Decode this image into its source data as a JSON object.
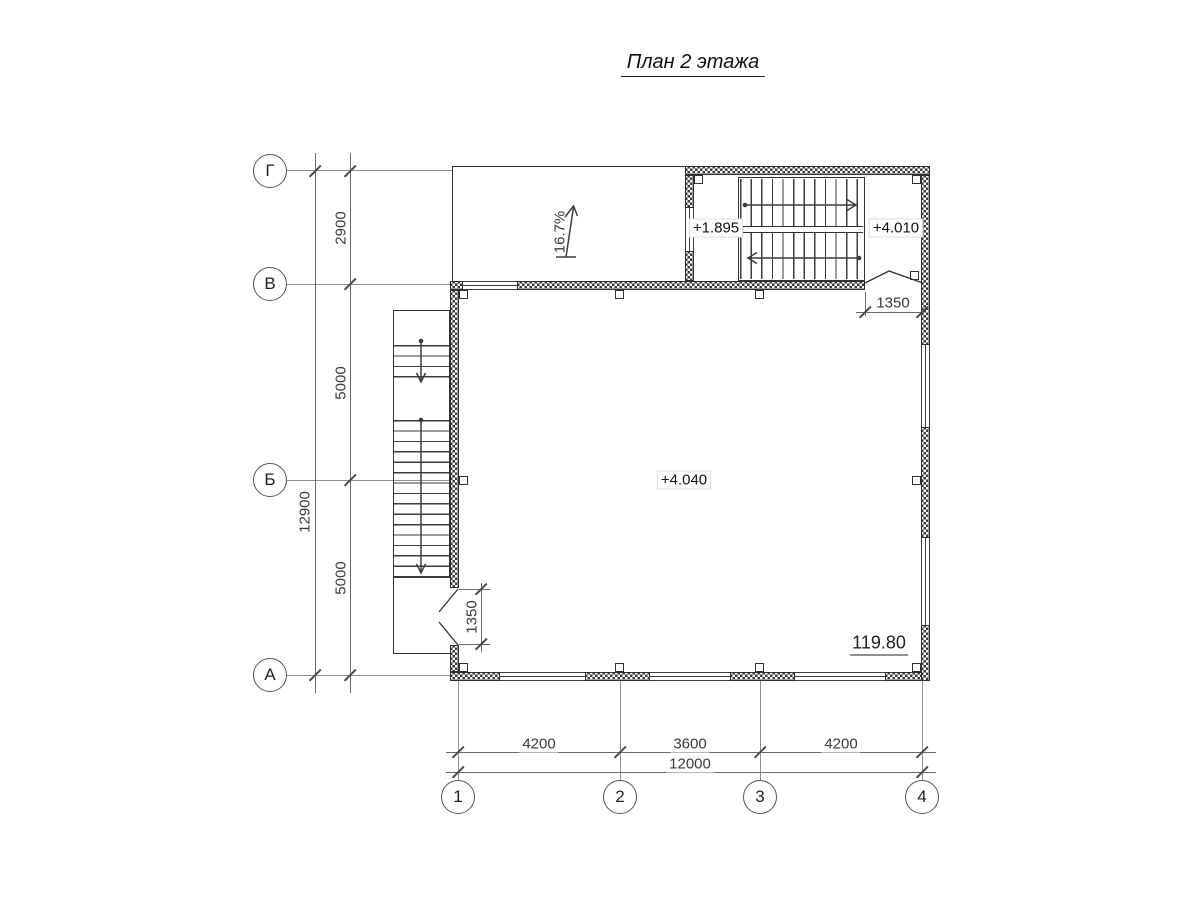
{
  "title": "План 2 этажа",
  "grid": {
    "rows": [
      {
        "label": "Г"
      },
      {
        "label": "В"
      },
      {
        "label": "Б"
      },
      {
        "label": "А"
      }
    ],
    "cols": [
      {
        "label": "1"
      },
      {
        "label": "2"
      },
      {
        "label": "3"
      },
      {
        "label": "4"
      }
    ]
  },
  "dims": {
    "left": {
      "segments": [
        "2900",
        "5000",
        "5000"
      ],
      "total": "12900"
    },
    "bottom": {
      "segments": [
        "4200",
        "3600",
        "4200"
      ],
      "total": "12000"
    },
    "left_door": "1350",
    "stair_door": "1350"
  },
  "levels": {
    "stair_landing": "+1.895",
    "stair_upper": "+4.010",
    "floor": "+4.040"
  },
  "ramp": {
    "slope": "16.7%"
  },
  "room": {
    "area": "119.80"
  },
  "colors": {
    "wall_line": "#2e2e2e",
    "grid_line": "#909090",
    "stair_line": "#3d3d3d"
  }
}
